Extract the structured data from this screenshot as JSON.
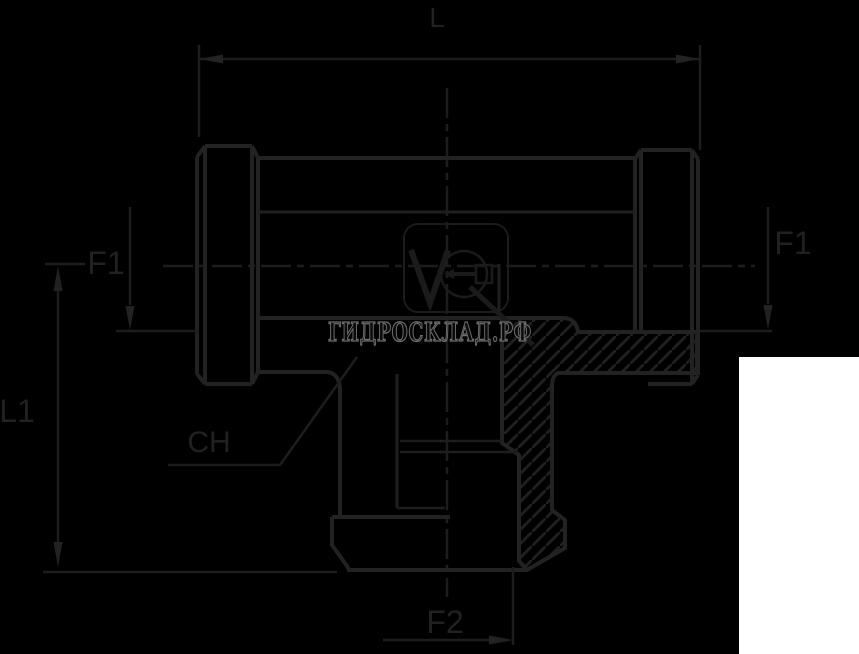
{
  "drawing": {
    "title": "tee-fitting-technical-drawing",
    "labels": {
      "length_top": "L",
      "thread_left": "F1",
      "thread_right": "F1",
      "height_left": "L1",
      "wrench_size": "CH",
      "thread_bottom": "F2"
    },
    "watermark": {
      "text": "ГИДРОСКЛАД.РФ",
      "logo": "V-circle-wrench-logo"
    },
    "colors": {
      "background": "#000000",
      "line_main": "#222222",
      "line_thin": "#1d1d1d",
      "watermark_outline": "#6e6e6e",
      "patch": "#ffffff"
    }
  }
}
